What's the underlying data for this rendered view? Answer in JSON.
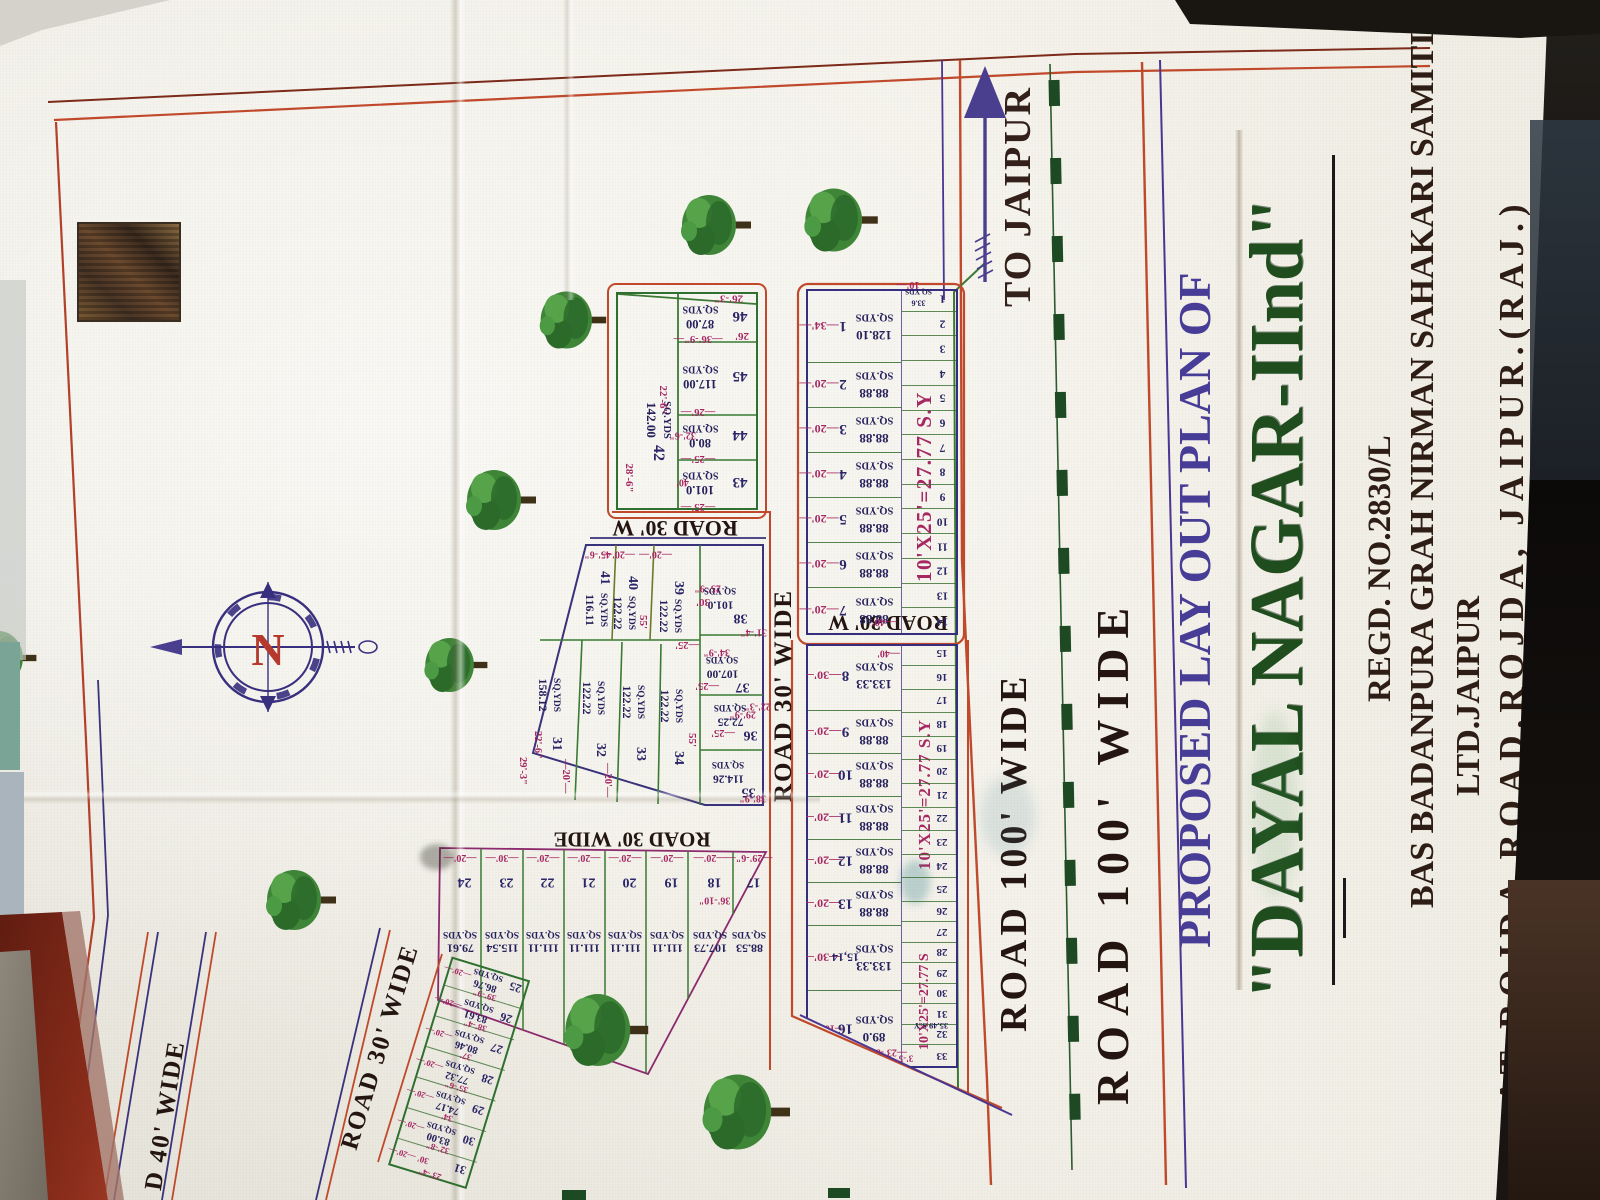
{
  "title_block": {
    "proposed": "PROPOSED LAY OUT PLAN OF",
    "name": "\"DAYAL NAGAR-IInd\"",
    "regd": "REGD. NO.2830/L",
    "society_line1": "BAS BADANPURA GRAH NIRMAN SAHAKARI SAMITI",
    "society_line2": "LTD.JAIPUR",
    "address": "AT ROJDA ROAD,ROJDA,  JAIPUR.(RAJ.)"
  },
  "compass": {
    "letter": "N"
  },
  "to_jaipur": "TO JAIPUR",
  "roads": {
    "r100_upper": "ROAD 100' WIDE",
    "r100_lower": "ROAD 100' WIDE",
    "r30_w_a": "ROAD 30' W",
    "r30_w_b": "ROAD 30' W",
    "r30_wide_h": "ROAD 30' WIDE",
    "r30_wide_v": "ROAD 30' WIDE",
    "r30_wide_diag": "ROAD 30' WIDE",
    "r40_wide": "D 40' WIDE"
  },
  "notes": {
    "size_note": "10'X25'=27.77 S.Y",
    "size_note_2": "10'X25'=27.77 S.Y",
    "size_note_3": "10'X25'=27.77 S.Y",
    "tip_area": "35.49 S.Y",
    "tip_dim": "3'-5\"",
    "unit": "SQ.YDS"
  },
  "strip1": {
    "main": [
      {
        "no": "1",
        "dim": "34'",
        "area": "128.10",
        "unit": "SQ.YDS"
      },
      {
        "no": "2",
        "dim": "20'",
        "area": "88.88",
        "unit": "SQ.YDS"
      },
      {
        "no": "3",
        "dim": "20'",
        "area": "88.88",
        "unit": "SQ.YDS"
      },
      {
        "no": "4",
        "dim": "20'",
        "area": "88.88",
        "unit": "SQ.YDS"
      },
      {
        "no": "5",
        "dim": "20'",
        "area": "88.88",
        "unit": "SQ.YDS"
      },
      {
        "no": "6",
        "dim": "20'",
        "area": "88.88",
        "unit": "SQ.YDS"
      },
      {
        "no": "7",
        "dim": "20'",
        "area": "88.88",
        "unit": "SQ.YDS"
      }
    ],
    "end_dim": "40'",
    "small": {
      "numbers": [
        "1",
        "2",
        "3",
        "4",
        "5",
        "6",
        "7",
        "8",
        "9",
        "10",
        "11",
        "12",
        "13",
        "14"
      ],
      "first_area": "33.6",
      "first_unit": "SQ.YDS",
      "first_dim": "10'"
    }
  },
  "strip2": {
    "main": [
      {
        "no": "8",
        "dim": "30'",
        "area": "133.33",
        "unit": "SQ.YDS",
        "extra": "40'"
      },
      {
        "no": "9",
        "dim": "20'",
        "area": "88.88",
        "unit": "SQ.YDS"
      },
      {
        "no": "10",
        "dim": "20'",
        "area": "88.88",
        "unit": "SQ.YDS"
      },
      {
        "no": "11",
        "dim": "20'",
        "area": "88.88",
        "unit": "SQ.YDS"
      },
      {
        "no": "12",
        "dim": "20'",
        "area": "88.88",
        "unit": "SQ.YDS"
      },
      {
        "no": "13",
        "dim": "20'",
        "area": "88.88",
        "unit": "SQ.YDS"
      },
      {
        "no": "15,14",
        "dim": "30'",
        "area": "133.33",
        "unit": "SQ.YDS"
      },
      {
        "no": "16",
        "dim": "16'-5\"",
        "area": "89.0",
        "unit": "SQ.YDS",
        "extra": "23'-8\""
      }
    ],
    "small": [
      "15",
      "16",
      "17",
      "18",
      "19",
      "20",
      "21",
      "22",
      "23",
      "24",
      "25",
      "26",
      "27",
      "28",
      "29",
      "30",
      "31",
      "32",
      "33"
    ]
  },
  "cluster_a": {
    "plots": [
      {
        "no": "42",
        "area": "142.00",
        "unit": "SQ.YDS",
        "dims": [
          "28'-6\"",
          "22'-6\""
        ]
      },
      {
        "no": "43",
        "area": "101.0",
        "unit": "SQ.YDS",
        "dim": "25'",
        "extra": "40'"
      },
      {
        "no": "44",
        "area": "80.0",
        "unit": "SQ.YDS",
        "dim": "25'",
        "extra": "32'-6\""
      },
      {
        "no": "45",
        "area": "117.00",
        "unit": "SQ.YDS",
        "dim": "26'"
      },
      {
        "no": "46",
        "area": "87.00",
        "unit": "SQ.YDS",
        "dim": "36'-9\""
      }
    ],
    "edge_dims": [
      "26'-3\"",
      "26'"
    ]
  },
  "cluster_b": {
    "plots": [
      {
        "no": "31",
        "area": "158.12",
        "unit": "SQ.YDS"
      },
      {
        "no": "32",
        "area": "122.22",
        "unit": "SQ.YDS"
      },
      {
        "no": "33",
        "area": "122.22",
        "unit": "SQ.YDS"
      },
      {
        "no": "34",
        "area": "122.22",
        "unit": "SQ.YDS"
      },
      {
        "no": "35",
        "area": "114.26",
        "unit": "SQ.YDS"
      },
      {
        "no": "36",
        "area": "72.25",
        "unit": "SQ.YDS"
      },
      {
        "no": "37",
        "area": "107.00",
        "unit": "SQ.YDS"
      },
      {
        "no": "38",
        "area": "101.0",
        "unit": "SQ.YDS"
      },
      {
        "no": "39",
        "area": "122.22",
        "unit": "SQ.YDS"
      },
      {
        "no": "40",
        "area": "122.22",
        "unit": "SQ.YDS"
      },
      {
        "no": "41",
        "area": "116.11",
        "unit": "SQ.YDS"
      }
    ],
    "dims": [
      "22'-6\"",
      "29'-3\"",
      "20'",
      "20'",
      "55'",
      "55'",
      "30'",
      "25'",
      "25'",
      "25'",
      "34'-9\"",
      "29'-9\"",
      "22'-3\"",
      "38'-9\"",
      "31'-4\"",
      "45'-6\"",
      "25'-9\"",
      "20'",
      "20'"
    ]
  },
  "cluster_d": {
    "plots": [
      {
        "no": "17",
        "area": "88.53",
        "unit": "SQ.YDS"
      },
      {
        "no": "18",
        "area": "107.73",
        "unit": "SQ.YDS"
      },
      {
        "no": "19",
        "area": "111.11",
        "unit": "SQ.YDS"
      },
      {
        "no": "20",
        "area": "111.11",
        "unit": "SQ.YDS"
      },
      {
        "no": "21",
        "area": "111.11",
        "unit": "SQ.YDS"
      },
      {
        "no": "22",
        "area": "111.11",
        "unit": "SQ.YDS"
      },
      {
        "no": "23",
        "area": "115.54",
        "unit": "SQ.YDS"
      },
      {
        "no": "24",
        "area": "79.61",
        "unit": "SQ.YDS"
      }
    ],
    "base_dims": [
      "29'-6\"",
      "20'",
      "20'",
      "20'",
      "20'",
      "20'",
      "30'",
      "20'"
    ],
    "extra_dim": "36'-10\""
  },
  "cluster_e": {
    "plots": [
      {
        "no": "25",
        "area": "86.76",
        "unit": "SQ.YDS"
      },
      {
        "no": "26",
        "area": "83.61",
        "unit": "SQ.YDS"
      },
      {
        "no": "27",
        "area": "80.46",
        "unit": "SQ.YDS"
      },
      {
        "no": "28",
        "area": "77.32",
        "unit": "SQ.YDS"
      },
      {
        "no": "29",
        "area": "74.17",
        "unit": "SQ.YDS"
      },
      {
        "no": "30",
        "area": "83.00",
        "unit": "SQ.YDS"
      },
      {
        "no": "31",
        "area": "",
        "unit": ""
      }
    ],
    "side_dims": [
      "39'-9\"",
      "38'-4\"",
      "37'",
      "35'-6\"",
      "34'",
      "32'-8\"",
      "23'-4\""
    ],
    "tick": "20'",
    "extra": "30'"
  }
}
